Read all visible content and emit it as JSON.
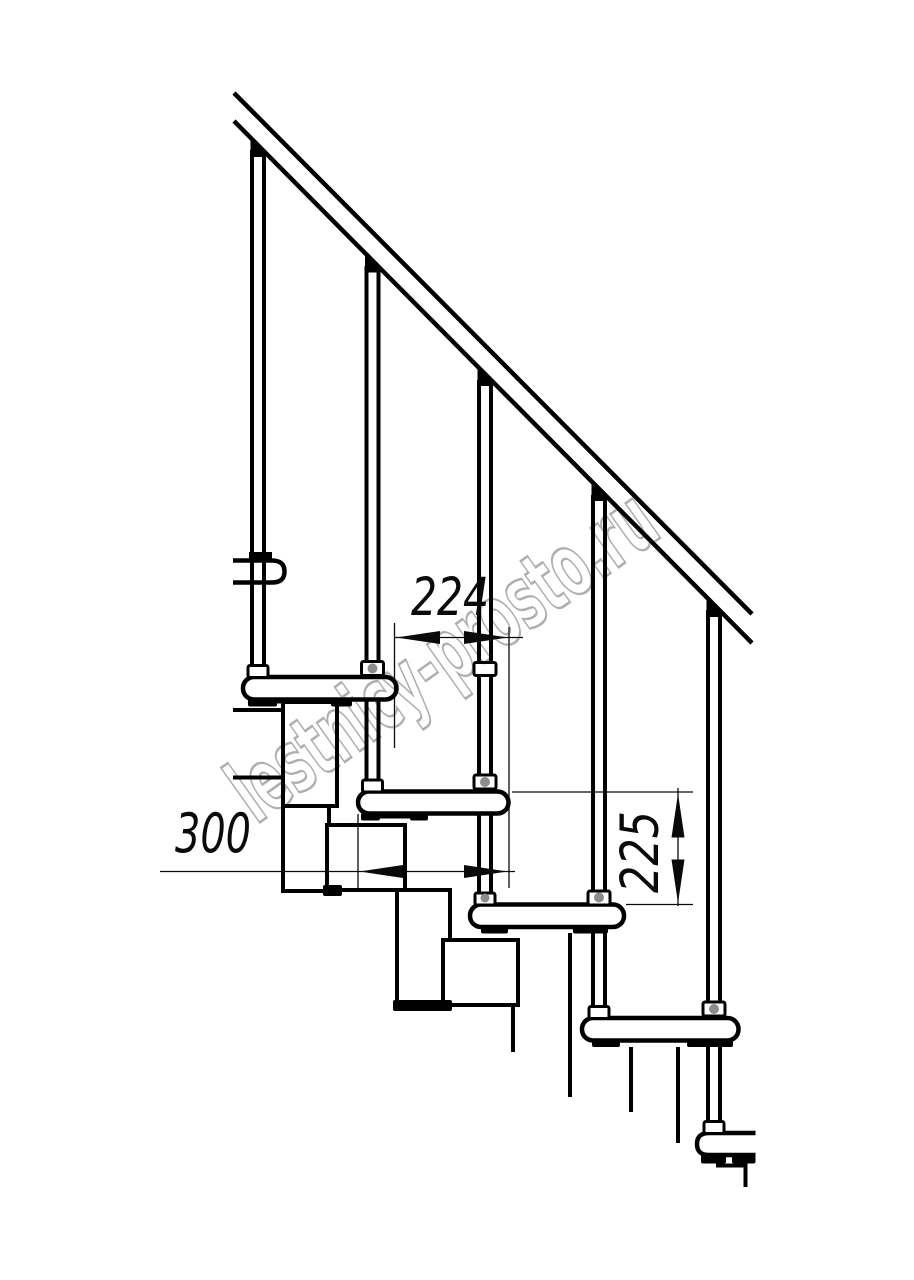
{
  "dimensions": {
    "going": {
      "value": "224"
    },
    "tread_depth": {
      "value": "300"
    },
    "rise": {
      "value": "225"
    }
  },
  "watermark": {
    "text": "lestnicy-prosto.ru"
  },
  "colors": {
    "line": "#000000",
    "background": "#ffffff",
    "watermark_grey": "#9e9e9e",
    "connector_grey": "#8d8d8d"
  }
}
